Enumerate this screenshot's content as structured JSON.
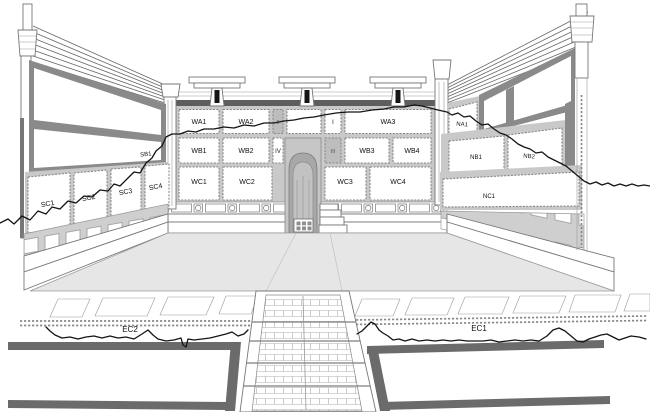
{
  "labels": {
    "WA1": "WA1",
    "WA2": "WA2",
    "WA3": "WA3",
    "WB1": "WB1",
    "WB2": "WB2",
    "WB3": "WB3",
    "WB4": "WB4",
    "WC1": "WC1",
    "WC2": "WC2",
    "WC3": "WC3",
    "WC4": "WC4",
    "I": "I",
    "II": "II",
    "III": "III",
    "IV": "IV",
    "SB1": "SB1",
    "SC1": "SC1",
    "SC2": "SC2",
    "SC3": "SC3",
    "SC4": "SC4",
    "NA1": "NA1",
    "NB1": "NB1",
    "NB2": "NB2",
    "NC1": "NC1",
    "EC1": "EC1",
    "EC2": "EC2"
  },
  "colors": {
    "outline": "#666666",
    "panel_border": "#868686",
    "wall_joint": "#c9c9c9",
    "frame_gray": "#8a8a8a",
    "floor_gray": "#e6e6e6",
    "catwalk_gray": "#6b6b6b",
    "niche_gray": "#a8a8a8",
    "survey_line": "#141414",
    "label_text": "#111111"
  }
}
